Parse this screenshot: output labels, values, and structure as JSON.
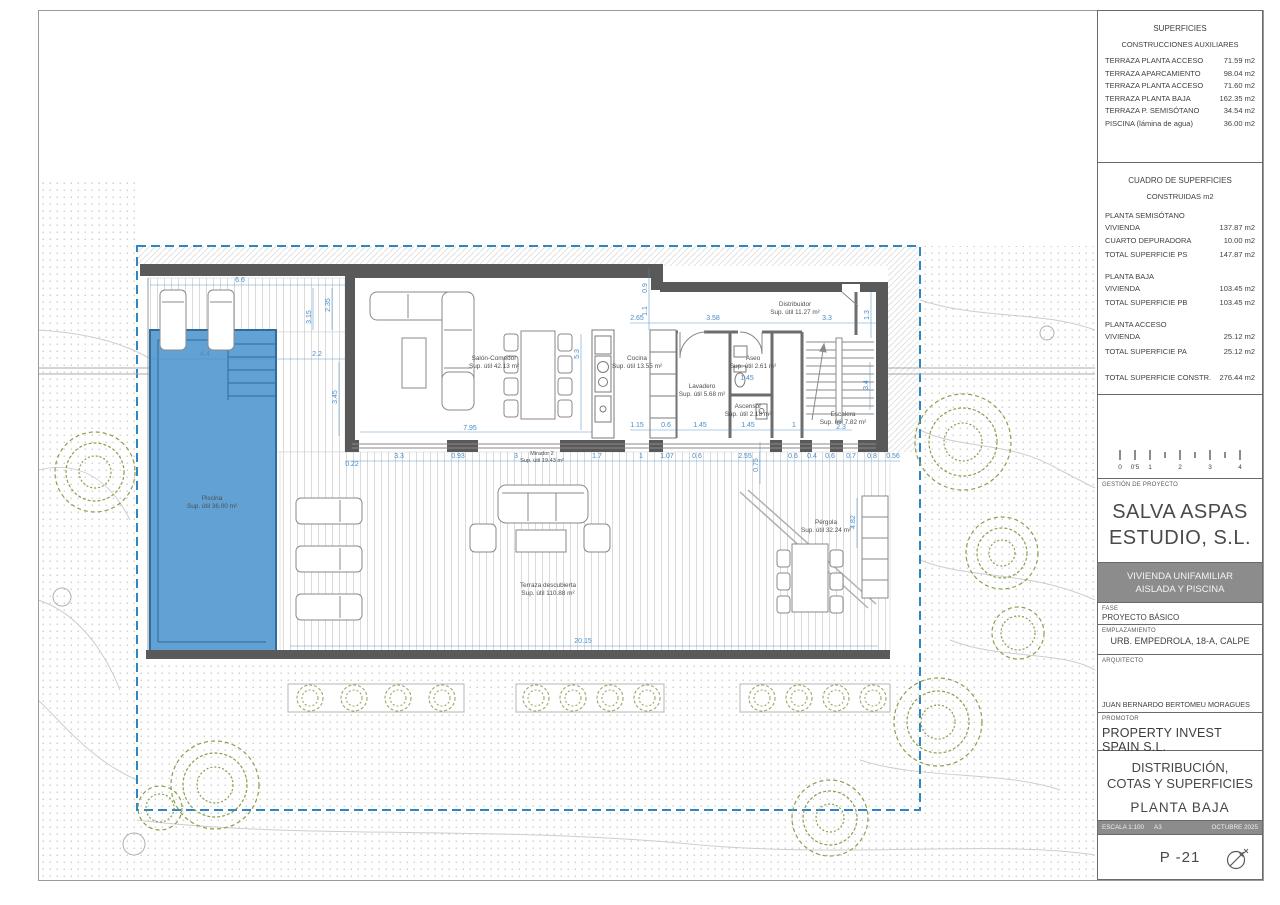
{
  "colors": {
    "dimension_blue": "#4a8bc7",
    "boundary_blue": "#2f86c2",
    "pool_fill": "#62a1d4",
    "pool_edge": "#2e6c9e",
    "wall_gray": "#595959",
    "band_gray": "#8c8c8c",
    "tree_green": "#86a04c"
  },
  "title_block": {
    "superficies": {
      "title": "SUPERFICIES",
      "subtitle": "CONSTRUCCIONES AUXILIARES",
      "rows": [
        {
          "label": "TERRAZA PLANTA ACCESO",
          "value": "71.59 m2"
        },
        {
          "label": "TERRAZA APARCAMIENTO",
          "value": "98.04 m2"
        },
        {
          "label": "TERRAZA PLANTA ACCESO",
          "value": "71.60 m2"
        },
        {
          "label": "TERRAZA PLANTA BAJA",
          "value": "162.35 m2"
        },
        {
          "label": "TERRAZA P. SEMISÓTANO",
          "value": "34.54 m2"
        },
        {
          "label": "PISCINA (lámina de agua)",
          "value": "36.00 m2"
        }
      ]
    },
    "cuadro": {
      "title": "CUADRO DE SUPERFICIES",
      "subtitle": "CONSTRUIDAS m2",
      "groups": [
        {
          "name": "PLANTA SEMISÓTANO",
          "rows": [
            {
              "label": "VIVIENDA",
              "value": "137.87 m2"
            },
            {
              "label": "CUARTO DEPURADORA",
              "value": "10.00 m2"
            }
          ],
          "total": {
            "label": "TOTAL SUPERFICIE PS",
            "value": "147.87 m2"
          }
        },
        {
          "name": "PLANTA BAJA",
          "rows": [
            {
              "label": "VIVIENDA",
              "value": "103.45 m2"
            }
          ],
          "total": {
            "label": "TOTAL SUPERFICIE PB",
            "value": "103.45 m2"
          }
        },
        {
          "name": "PLANTA ACCESO",
          "rows": [
            {
              "label": "VIVIENDA",
              "value": "25.12 m2"
            }
          ],
          "total": {
            "label": "TOTAL SUPERFICIE PA",
            "value": "25.12 m2"
          }
        }
      ],
      "grand_total": {
        "label": "TOTAL SUPERFICIE CONSTR.",
        "value": "276.44 m2"
      }
    },
    "scale_ticks": [
      "0",
      "0'5",
      "1",
      "2",
      "3",
      "4"
    ],
    "gestion_label": "GESTIÓN DE PROYECTO",
    "studio_line1": "SALVA ASPAS",
    "studio_line2": "ESTUDIO, S.L.",
    "band_line1": "VIVIENDA UNIFAMILIAR",
    "band_line2": "AISLADA Y PISCINA",
    "fase": {
      "label": "FASE",
      "value": "PROYECTO BÁSICO"
    },
    "emplazamiento": {
      "label": "EMPLAZAMIENTO",
      "value": "URB. EMPEDROLA, 18-A, CALPE"
    },
    "arquitecto": {
      "label": "ARQUITECTO",
      "value": "JUAN BERNARDO BERTOMEU MORAGUES"
    },
    "promotor": {
      "label": "PROMOTOR",
      "value": "PROPERTY INVEST SPAIN S.L."
    },
    "sheet_title": {
      "line1": "DISTRIBUCIÓN,",
      "line2": "COTAS Y SUPERFICIES",
      "line3": "PLANTA BAJA"
    },
    "meta": {
      "escala": "ESCALA 1:100",
      "formato": "A3",
      "fecha": "OCTUBRE 2025"
    },
    "sheet_number": "P -21"
  },
  "plan": {
    "rooms": {
      "salon": {
        "name": "Salón-Comedor",
        "area": "Sup. útil 42.13 m²"
      },
      "cocina": {
        "name": "Cocina",
        "area": "Sup. útil 13.55 m²"
      },
      "lavadero": {
        "name": "Lavadero",
        "area": "Sup. útil 5.68 m²"
      },
      "aseo": {
        "name": "Aseo",
        "area": "Sup. útil 2.61 m²"
      },
      "ascensor": {
        "name": "Ascensor",
        "area": "Sup. útil 2.18 m²"
      },
      "distribuidor": {
        "name": "Distribuidor",
        "area": "Sup. útil 11.27 m²"
      },
      "escalera": {
        "name": "Escalera",
        "area": "Sup. útil 7.82 m²"
      },
      "mirador": {
        "name": "Mirador 2",
        "area": "Sup. útil 19.43 m²"
      },
      "terraza": {
        "name": "Terraza descubierta",
        "area": "Sup. útil 110.88 m²"
      },
      "pergola": {
        "name": "Pérgola",
        "area": "Sup. útil 32.24 m²"
      },
      "piscina": {
        "name": "Piscina",
        "area": "Sup. útil 36.00 m²"
      }
    },
    "dims": {
      "d66": "6.6",
      "d315": "3.15",
      "d235": "2.35",
      "d44": "4.4",
      "d22": "2.2",
      "d345": "3.45",
      "d022": "0.22",
      "d33a": "3.3",
      "d093": "0.93",
      "d3": "3",
      "d17": "1.7",
      "d1a": "1",
      "d107": "1.07",
      "d06a": "0.6",
      "d255": "2.55",
      "d06b": "0.6",
      "d04": "0.4",
      "d06c": "0.6",
      "d07": "0.7",
      "d08": "0.8",
      "d056": "0.56",
      "d795": "7.95",
      "d53": "5.3",
      "d265": "2.65",
      "d09": "0.9",
      "d11": "1.1",
      "d358": "3.58",
      "d33b": "3.3",
      "d13": "1.3",
      "d115": "1.15",
      "d06d": "0.6",
      "d145a": "1.45",
      "d145b": "1.45",
      "d1b": "1",
      "d23": "2.3",
      "d34": "3.4",
      "d145c": "1.45",
      "d075": "0.75",
      "d482": "4.82",
      "d2015": "20.15"
    }
  }
}
